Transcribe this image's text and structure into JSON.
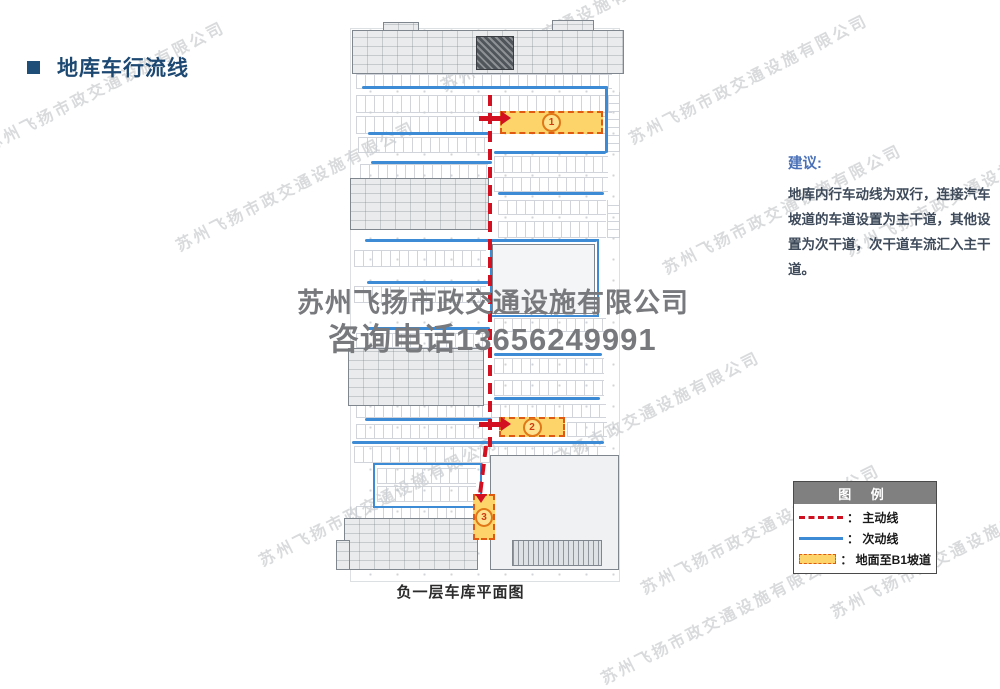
{
  "title": {
    "text": "地库车行流线"
  },
  "watermark": {
    "diagonal_text": "苏州飞扬市政交通设施有限公司",
    "center_line1": "苏州飞扬市政交通设施有限公司",
    "center_line2": "咨询电话13656249991"
  },
  "suggestion": {
    "heading": "建议:",
    "body": "地库内行车动线为双行，连接汽车坡道的车道设置为主干道，其他设置为次干道，次干道车流汇入主干道。"
  },
  "legend": {
    "title": "图  例",
    "items": [
      {
        "type": "dashed-red",
        "label": "： 主动线"
      },
      {
        "type": "solid-blue",
        "label": "： 次动线"
      },
      {
        "type": "orange-box",
        "label": "： 地面至B1坡道"
      }
    ]
  },
  "plan": {
    "caption": "负一层车库平面图",
    "ramps": [
      {
        "num": "1"
      },
      {
        "num": "2"
      },
      {
        "num": "3"
      }
    ]
  },
  "colors": {
    "accent_title": "#1f4e79",
    "main_line_red": "#d21022",
    "secondary_line_blue": "#3d8bd4",
    "ramp_fill": "#fcd469",
    "ramp_border": "#e05a12",
    "legend_header_gray": "#808080"
  }
}
